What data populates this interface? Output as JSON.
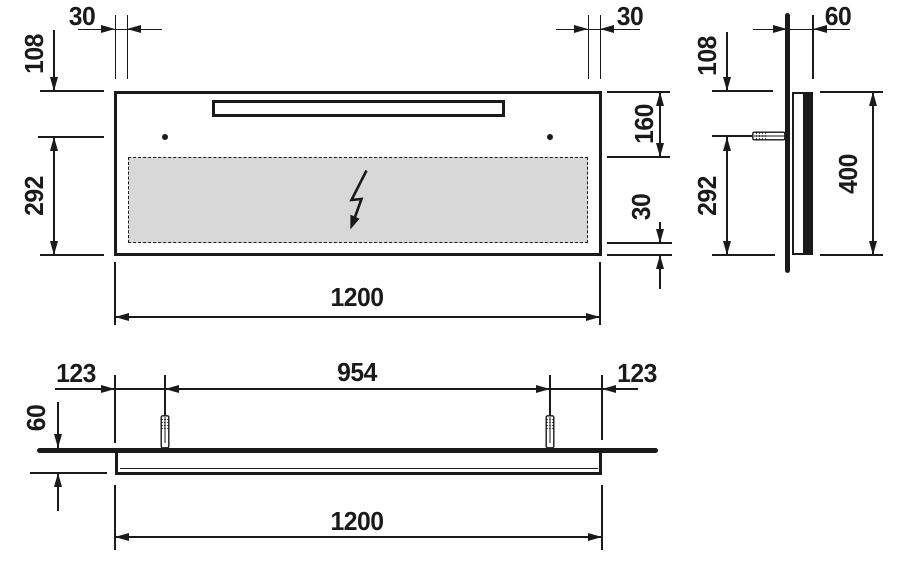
{
  "drawing": {
    "type": "technical-dimension-drawing",
    "views": {
      "front": {
        "dimensions": {
          "panel_inset_left": "30",
          "panel_inset_right": "30",
          "top_to_fixings": "108",
          "fixings_to_bottom": "292",
          "top_to_panel": "160",
          "panel_to_bottom": "30",
          "overall_width": "1200"
        }
      },
      "side": {
        "dimensions": {
          "depth": "60",
          "top_to_fixing": "108",
          "fixing_to_bottom": "292",
          "overall_height": "400"
        }
      },
      "plan": {
        "dimensions": {
          "edge_to_fixing_left": "123",
          "fixing_centres": "954",
          "edge_to_fixing_right": "123",
          "depth": "60",
          "overall_width": "1200"
        }
      }
    },
    "symbols": {
      "lightning_bolt": "electrical-connection-indicator",
      "wall_plug": "wall-anchor",
      "fixing_dot": "fixing-point"
    },
    "colors": {
      "line": "#1a1a1a",
      "panel_fill": "#d8d8d8",
      "background": "#ffffff"
    }
  }
}
